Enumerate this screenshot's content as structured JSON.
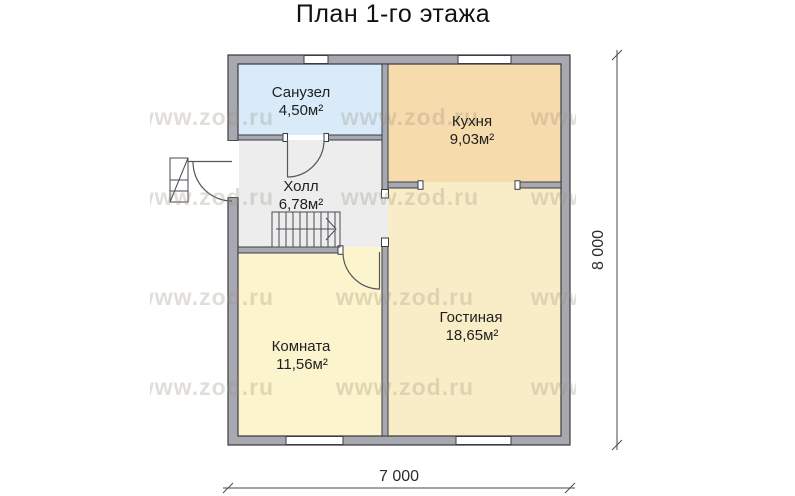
{
  "title": "План 1-го этажа",
  "plan": {
    "rooms": {
      "bathroom": {
        "name": "Санузел",
        "area": "4,50м²",
        "color": "#d9ebf8"
      },
      "kitchen": {
        "name": "Кухня",
        "area": "9,03м²",
        "color": "#f6dbad"
      },
      "hall": {
        "name": "Холл",
        "area": "6,78м²",
        "color": "#ededed"
      },
      "bedroom": {
        "name": "Комната",
        "area": "11,56м²",
        "color": "#fcf4cc"
      },
      "living": {
        "name": "Гостиная",
        "area": "18,65м²",
        "color": "#f9edc7"
      }
    },
    "dimensions": {
      "height": "8 000",
      "width": "7 000"
    },
    "watermark": "www.zod.ru",
    "colors": {
      "wall": "#a8a8b0",
      "line": "#3c3c44",
      "window": "#ffffff",
      "watermark": "#968d7a"
    }
  }
}
